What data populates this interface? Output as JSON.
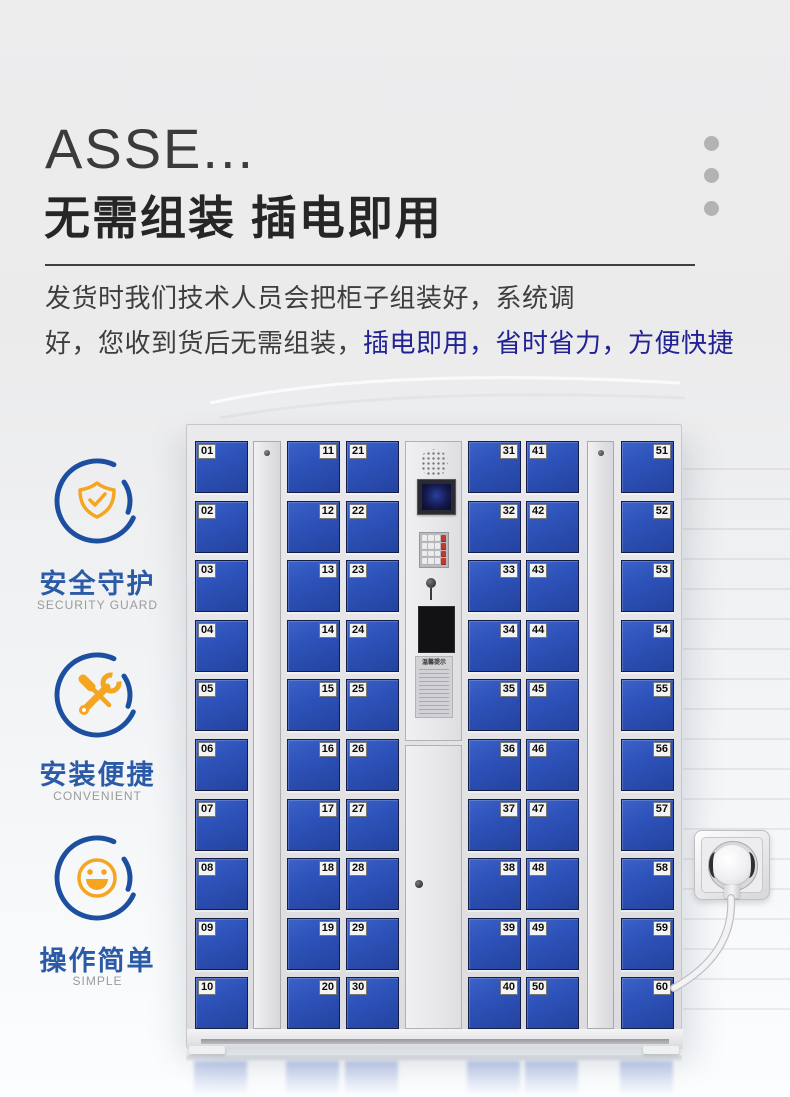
{
  "header": {
    "title_en": "ASSE...",
    "title_cn": "无需组装  插电即用",
    "desc_line1": "发货时我们技术人员会把柜子组装好，系统调",
    "desc_line2_plain": "好，您收到货后无需组装，",
    "desc_line2_accent": "插电即用，省时省力，方便快捷"
  },
  "features": [
    {
      "icon": "shield-check-icon",
      "label": "安全守护",
      "sublabel": "SECURITY GUARD"
    },
    {
      "icon": "wrench-screwdriver-icon",
      "label": "安装便捷",
      "sublabel": "CONVENIENT"
    },
    {
      "icon": "smiley-icon",
      "label": "操作简单",
      "sublabel": "SIMPLE"
    }
  ],
  "locker": {
    "columns": [
      {
        "type": "doors",
        "label_side": "left",
        "numbers": [
          "01",
          "02",
          "03",
          "04",
          "05",
          "06",
          "07",
          "08",
          "09",
          "10"
        ]
      },
      {
        "type": "doors",
        "label_side": "right",
        "numbers": [
          "11",
          "12",
          "13",
          "14",
          "15",
          "16",
          "17",
          "18",
          "19",
          "20"
        ]
      },
      {
        "type": "doors",
        "label_side": "left",
        "numbers": [
          "21",
          "22",
          "23",
          "24",
          "25",
          "26",
          "27",
          "28",
          "29",
          "30"
        ]
      },
      {
        "type": "doors",
        "label_side": "right",
        "numbers": [
          "31",
          "32",
          "33",
          "34",
          "35",
          "36",
          "37",
          "38",
          "39",
          "40"
        ]
      },
      {
        "type": "doors",
        "label_side": "left",
        "numbers": [
          "41",
          "42",
          "43",
          "44",
          "45",
          "46",
          "47",
          "48",
          "49",
          "50"
        ]
      },
      {
        "type": "doors",
        "label_side": "right",
        "numbers": [
          "51",
          "52",
          "53",
          "54",
          "55",
          "56",
          "57",
          "58",
          "59",
          "60"
        ]
      }
    ],
    "control_panel": {
      "sticker_title": "温馨提示"
    }
  },
  "colors": {
    "door_blue": "#2d52b9",
    "accent_navy": "#222294",
    "feature_blue": "#2b5aa7",
    "ring_blue": "#1d4fa0",
    "icon_orange": "#f5a51f",
    "title_dark": "#2a2a2a"
  }
}
